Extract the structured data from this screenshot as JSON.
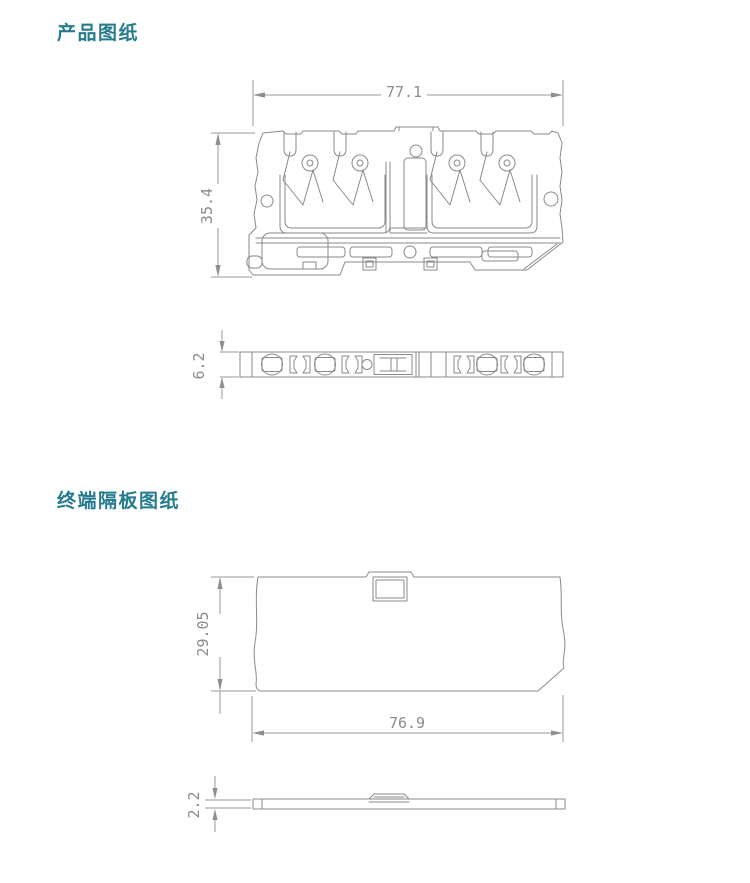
{
  "page": {
    "background": "#ffffff",
    "accent_color": "#267c8e",
    "drawing_line_color": "#8a8a8a",
    "dimension_text_color": "#8c8c8c"
  },
  "sections": [
    {
      "id": "product-drawing",
      "title": "产品图纸",
      "figures": [
        {
          "name": "terminal-block-side-view",
          "dimensions": [
            {
              "label": "77.1",
              "orientation": "horizontal",
              "edge": "top"
            },
            {
              "label": "35.4",
              "orientation": "vertical",
              "edge": "left"
            }
          ]
        },
        {
          "name": "terminal-block-top-view",
          "dimensions": [
            {
              "label": "6.2",
              "orientation": "vertical",
              "edge": "left"
            }
          ]
        }
      ]
    },
    {
      "id": "end-plate-drawing",
      "title": "终端隔板图纸",
      "figures": [
        {
          "name": "end-plate-front-view",
          "dimensions": [
            {
              "label": "29.05",
              "orientation": "vertical",
              "edge": "left"
            },
            {
              "label": "76.9",
              "orientation": "horizontal",
              "edge": "bottom"
            }
          ]
        },
        {
          "name": "end-plate-side-view",
          "dimensions": [
            {
              "label": "2.2",
              "orientation": "vertical",
              "edge": "left"
            }
          ]
        }
      ]
    }
  ]
}
